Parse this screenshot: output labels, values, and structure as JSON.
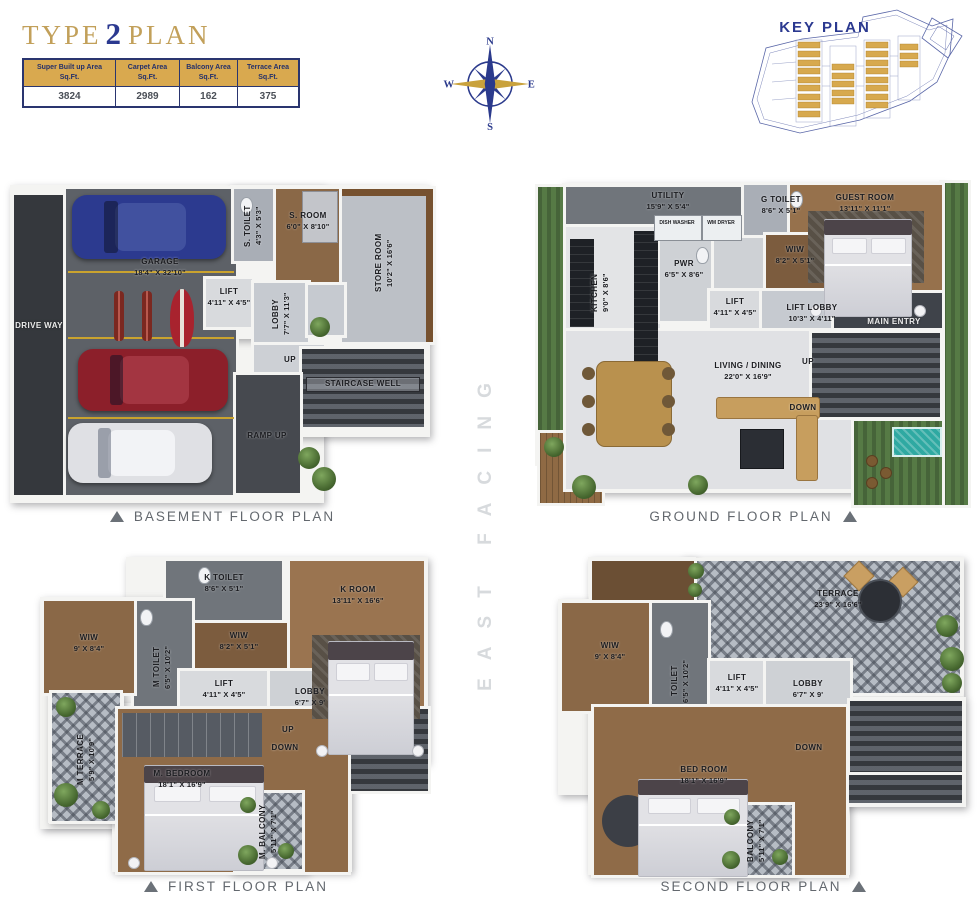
{
  "page": {
    "title": {
      "word1": "TYPE",
      "number": "2",
      "word2": "PLAN"
    }
  },
  "colors": {
    "gold": "#c9a23c",
    "navy": "#2b3a8c",
    "table_header": "#d9a94f",
    "caption_gray": "#63686e",
    "facing_gray": "#d7dadd",
    "key_highlight": "#d7a94e"
  },
  "area_table": {
    "columns": [
      {
        "label": "Super Built up Area",
        "unit": "Sq.Ft.",
        "value": "3824"
      },
      {
        "label": "Carpet Area",
        "unit": "Sq.Ft.",
        "value": "2989"
      },
      {
        "label": "Balcony Area",
        "unit": "Sq.Ft.",
        "value": "162"
      },
      {
        "label": "Terrace Area",
        "unit": "Sq.Ft.",
        "value": "375"
      }
    ]
  },
  "compass": {
    "north": "N",
    "east": "E",
    "south": "S",
    "west": "W"
  },
  "key_plan": {
    "title": "KEY PLAN"
  },
  "facing": "EAST FACING",
  "plans": {
    "basement": {
      "caption": "BASEMENT FLOOR PLAN",
      "rooms": {
        "drive_way": {
          "name": "DRIVE WAY"
        },
        "garage": {
          "name": "GARAGE",
          "dims": "18'4\" X 32'10\""
        },
        "s_toilet": {
          "name": "S. TOILET",
          "dims": "4'3\" X 5'3\""
        },
        "s_room": {
          "name": "S. ROOM",
          "dims": "6'0\" X 8'10\""
        },
        "store_room": {
          "name": "STORE ROOM",
          "dims": "10'2\" X 16'6\""
        },
        "lift": {
          "name": "LIFT",
          "dims": "4'11\" X 4'5\""
        },
        "lobby": {
          "name": "LOBBY",
          "dims": "7'7\" X 11'3\""
        },
        "up": {
          "name": "UP"
        },
        "staircase_well": {
          "name": "STAIRCASE WELL"
        },
        "ramp_up": {
          "name": "RAMP UP"
        }
      }
    },
    "ground": {
      "caption": "GROUND FLOOR PLAN",
      "rooms": {
        "utility": {
          "name": "UTILITY",
          "dims": "15'9\" X 5'4\""
        },
        "kitchen": {
          "name": "KITCHEN",
          "dims": "9'0\" X 8'6\""
        },
        "dish_washer": {
          "name": "DISH WASHER"
        },
        "wm_dryer": {
          "name": "WM DRYER"
        },
        "pwr": {
          "name": "PWR",
          "dims": "6'5\" X 8'6\""
        },
        "g_toilet": {
          "name": "G TOILET",
          "dims": "8'6\" X 5'1\""
        },
        "wiw": {
          "name": "WIW",
          "dims": "8'2\" X 5'1\""
        },
        "guest_room": {
          "name": "GUEST ROOM",
          "dims": "13'11\" X 11'1\""
        },
        "lift": {
          "name": "LIFT",
          "dims": "4'11\" X 4'5\""
        },
        "lift_lobby": {
          "name": "LIFT LOBBY",
          "dims": "10'3\" X 4'11\""
        },
        "main_entry": {
          "name": "MAIN ENTRY"
        },
        "living_dining": {
          "name": "LIVING / DINING",
          "dims": "22'0\" X 16'9\""
        },
        "up": {
          "name": "UP"
        },
        "down": {
          "name": "DOWN"
        }
      }
    },
    "first": {
      "caption": "FIRST FLOOR PLAN",
      "rooms": {
        "k_toilet": {
          "name": "K TOILET",
          "dims": "8'6\" X 5'1\""
        },
        "wiw_k": {
          "name": "WIW",
          "dims": "8'2\" X 5'1\""
        },
        "k_room": {
          "name": "K ROOM",
          "dims": "13'11\" X 16'6\""
        },
        "m_toilet": {
          "name": "M TOILET",
          "dims": "6'5\" X 10'2\""
        },
        "wiw_m": {
          "name": "WIW",
          "dims": "9' X 8'4\""
        },
        "m_terrace": {
          "name": "M TERRACE",
          "dims": "5'9\" X 10'9\""
        },
        "lift": {
          "name": "LIFT",
          "dims": "4'11\" X 4'5\""
        },
        "lobby": {
          "name": "LOBBY",
          "dims": "6'7\" X 9'"
        },
        "up": {
          "name": "UP"
        },
        "down": {
          "name": "DOWN"
        },
        "m_bedroom": {
          "name": "M. BEDROOM",
          "dims": "18'1\" X 16'9\""
        },
        "m_balcony": {
          "name": "M. BALCONY",
          "dims": "5'11\" X 7'1\""
        }
      }
    },
    "second": {
      "caption": "SECOND FLOOR PLAN",
      "rooms": {
        "terrace": {
          "name": "TERRACE",
          "dims": "23'9\" X 16'6\""
        },
        "wiw": {
          "name": "WIW",
          "dims": "9' X 8'4\""
        },
        "toilet": {
          "name": "TOILET",
          "dims": "6'5\" X 10'2\""
        },
        "lift": {
          "name": "LIFT",
          "dims": "4'11\" X 4'5\""
        },
        "lobby": {
          "name": "LOBBY",
          "dims": "6'7\" X 9'"
        },
        "down": {
          "name": "DOWN"
        },
        "bed_room": {
          "name": "BED ROOM",
          "dims": "18'1\" X 16'9\""
        },
        "balcony": {
          "name": "BALCONY",
          "dims": "5'11\" X 7'1\""
        }
      }
    }
  }
}
